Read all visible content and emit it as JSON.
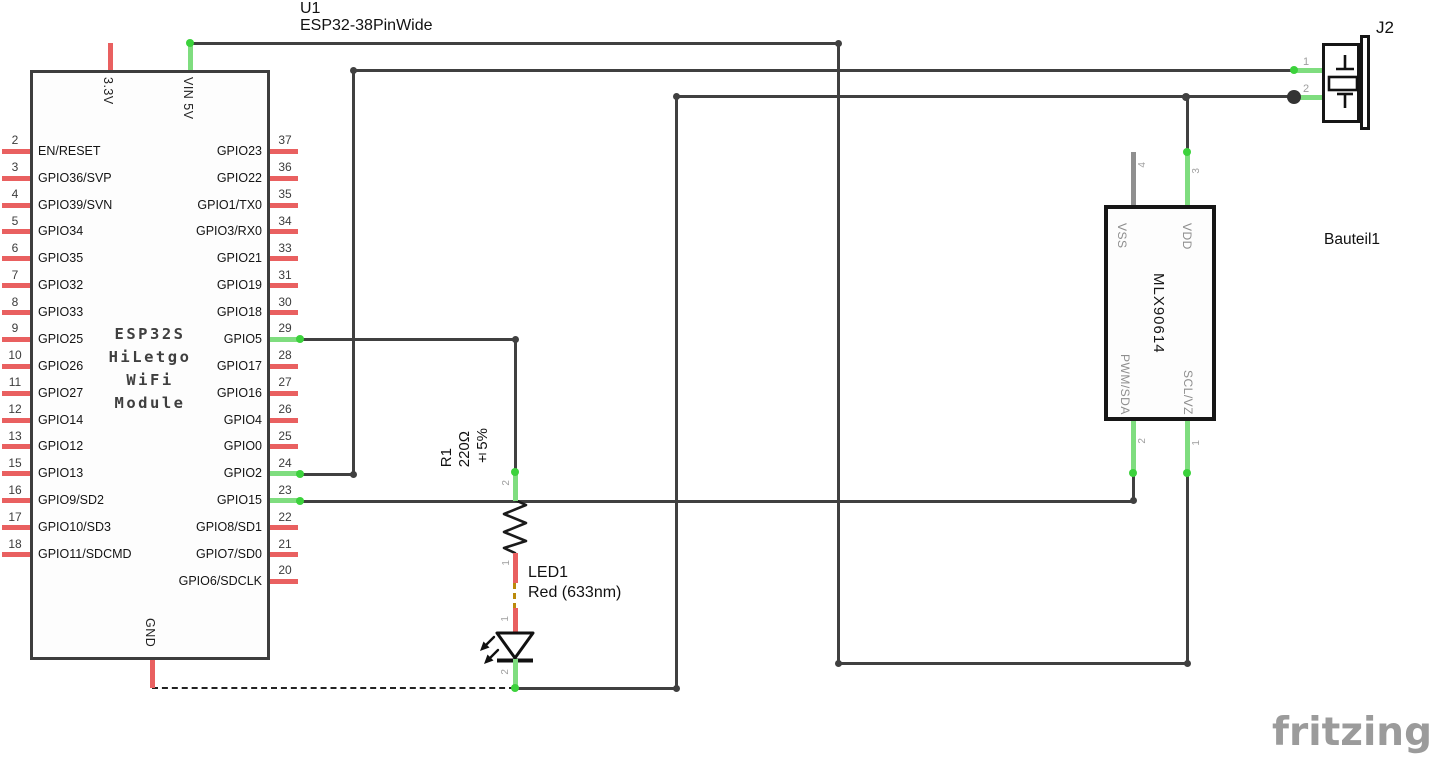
{
  "u1": {
    "ref": "U1",
    "value": "ESP32-38PinWide",
    "title_lines": [
      "ESP32S",
      "HiLetgo",
      "WiFi",
      "Module"
    ],
    "top_pins": [
      {
        "label": "3.3V",
        "state": "red"
      },
      {
        "label": "VIN 5V",
        "state": "green"
      }
    ],
    "bottom_pins": [
      {
        "label": "GND",
        "state": "red"
      }
    ],
    "left_pins": [
      {
        "num": "2",
        "label": "EN/RESET",
        "state": "red"
      },
      {
        "num": "3",
        "label": "GPIO36/SVP",
        "state": "red"
      },
      {
        "num": "4",
        "label": "GPIO39/SVN",
        "state": "red"
      },
      {
        "num": "5",
        "label": "GPIO34",
        "state": "red"
      },
      {
        "num": "6",
        "label": "GPIO35",
        "state": "red"
      },
      {
        "num": "7",
        "label": "GPIO32",
        "state": "red"
      },
      {
        "num": "8",
        "label": "GPIO33",
        "state": "red"
      },
      {
        "num": "9",
        "label": "GPIO25",
        "state": "red"
      },
      {
        "num": "10",
        "label": "GPIO26",
        "state": "red"
      },
      {
        "num": "11",
        "label": "GPIO27",
        "state": "red"
      },
      {
        "num": "12",
        "label": "GPIO14",
        "state": "red"
      },
      {
        "num": "13",
        "label": "GPIO12",
        "state": "red"
      },
      {
        "num": "15",
        "label": "GPIO13",
        "state": "red"
      },
      {
        "num": "16",
        "label": "GPIO9/SD2",
        "state": "red"
      },
      {
        "num": "17",
        "label": "GPIO10/SD3",
        "state": "red"
      },
      {
        "num": "18",
        "label": "GPIO11/SDCMD",
        "state": "red"
      }
    ],
    "right_pins": [
      {
        "num": "37",
        "label": "GPIO23",
        "state": "red"
      },
      {
        "num": "36",
        "label": "GPIO22",
        "state": "red"
      },
      {
        "num": "35",
        "label": "GPIO1/TX0",
        "state": "red"
      },
      {
        "num": "34",
        "label": "GPIO3/RX0",
        "state": "red"
      },
      {
        "num": "33",
        "label": "GPIO21",
        "state": "red"
      },
      {
        "num": "31",
        "label": "GPIO19",
        "state": "red"
      },
      {
        "num": "30",
        "label": "GPIO18",
        "state": "red"
      },
      {
        "num": "29",
        "label": "GPIO5",
        "state": "green"
      },
      {
        "num": "28",
        "label": "GPIO17",
        "state": "red"
      },
      {
        "num": "27",
        "label": "GPIO16",
        "state": "red"
      },
      {
        "num": "26",
        "label": "GPIO4",
        "state": "red"
      },
      {
        "num": "25",
        "label": "GPIO0",
        "state": "red"
      },
      {
        "num": "24",
        "label": "GPIO2",
        "state": "green"
      },
      {
        "num": "23",
        "label": "GPIO15",
        "state": "green"
      },
      {
        "num": "22",
        "label": "GPIO8/SD1",
        "state": "red"
      },
      {
        "num": "21",
        "label": "GPIO7/SD0",
        "state": "red"
      },
      {
        "num": "20",
        "label": "GPIO6/SDCLK",
        "state": "red"
      }
    ]
  },
  "r1": {
    "ref": "R1",
    "value": "220Ω",
    "tolerance": "±5%",
    "pin_top_num": "2",
    "pin_bottom_num": "1"
  },
  "led1": {
    "ref": "LED1",
    "value": "Red (633nm)",
    "pin_top_num": "1",
    "pin_bottom_num": "2"
  },
  "sensor": {
    "name": "MLX90614",
    "part_label": "Bauteil1",
    "pins": [
      {
        "num": "4",
        "label": "VSS"
      },
      {
        "num": "3",
        "label": "VDD"
      },
      {
        "num": "2",
        "label": "PWM/SDA"
      },
      {
        "num": "1",
        "label": "SCL/VZ"
      }
    ]
  },
  "j2": {
    "ref": "J2",
    "pins": [
      {
        "num": "1"
      },
      {
        "num": "2"
      }
    ]
  },
  "watermark": "fritzing",
  "colors": {
    "wire": "#404040",
    "pin_unconnected": "#e96060",
    "pin_connected": "#3cd23c",
    "pin_nc_gray": "#8f8f8f",
    "ratsnest_gold": "#bb8a0b",
    "ratsnest_black": "#222222",
    "junction": "#333333"
  }
}
